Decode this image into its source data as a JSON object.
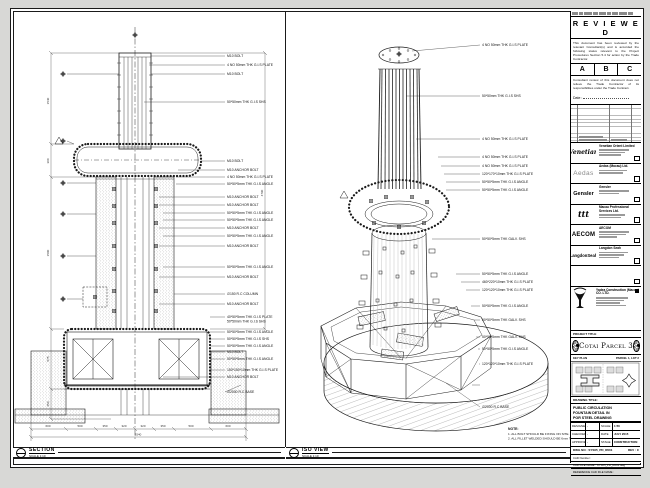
{
  "left_view": {
    "title": "SECTION",
    "scale": "SCALE 1:10",
    "labels": [
      "M10 BOLT",
      "4 NO 50mm THK G.I.S PLATE",
      "M10 BOLT",
      "50*50mm THK G.I.S SHS",
      "M10 BOLT",
      "M10 ANCHOR BOLT",
      "4 NO 50mm THK G.I.S PLATE",
      "50*50*5mm THK G.I.S ANGLE",
      "M10 ANCHOR BOLT",
      "M10 ANCHOR BOLT",
      "50*50*5mm THK G.I.S ANGLE",
      "50*50*5mm THK G.I.S ANGLE",
      "M10 ANCHOR BOLT",
      "50*50*5mm THK G.I.S ANGLE",
      "M10 ANCHOR BOLT",
      "50*50*5mm THK G.I.S ANGLE",
      "M10 ANCHOR BOLT",
      "∅150 R.C COLUMN",
      "M10 ANCHOR BOLT",
      "40*50*5mm THK G.I.S PLATE",
      "50*50mm THK G.I.S SHS",
      "50*50*5mm THK G.I.S ANGLE",
      "50*50*5mm THK G.I.S SHS",
      "50*50*5mm THK G.I.S ANGLE",
      "M10 BOLT",
      "50*50*5mm THK G.I.S ANGLE",
      "150*150*10mm THK G.I.S PLATE",
      "M10 ANCHOR BOLT",
      "∅2000 R.C BASE"
    ],
    "dims_left": [
      "1540",
      "300",
      "1500",
      "575",
      "650"
    ],
    "dim_right": "4790",
    "dims_bottom": [
      "600",
      "500",
      "350",
      "320",
      "320",
      "350",
      "500",
      "600"
    ],
    "dim_total": "3540"
  },
  "iso_view": {
    "title": "ISO VIEW",
    "scale": "SCALE 1:10",
    "labels": [
      "4 NO 50mm THK G.I.S PLATE",
      "50*50mm THK G.I.S SHS",
      "4 NO 50mm THK G.I.S PLATE",
      "4 NO 50mm THK G.I.S PLATE",
      "4 NO 50mm THK G.I.S PLATE",
      "120*170*10mm THK G.I.S PLATE",
      "50*50*5mm THK G.I.S ANGLE",
      "50*50*5mm THK G.I.S ANGLE",
      "50*50*5mm THK GALV. SHS",
      "50*50*5mm THK G.I.S ANGLE",
      "460*220*10mm THK G.I.S PLATE",
      "120*120*10mm THK G.I.S PLATE",
      "50*50*5mm THK G.I.S ANGLE",
      "50*50*5mm THK GALV. SHS",
      "50*50*5mm THK GALV. SHS",
      "50*50*5mm THK G.I.S ANGLE",
      "120*120*10mm THK G.I.S PLATE",
      "∅2000 R.C BASE"
    ],
    "note_title": "NOTE:",
    "note_line1": "1. ALL BOLT SHOULD BE FIXING ON SITE.",
    "note_line2": "2. ALL FILLET WELDED SHOULD BE 6mm THK."
  },
  "title_block": {
    "stamp": {
      "title": "R E V I E W E D",
      "para1": "This document has been reviewed by the relevant Consultant(s) and is accorded the following status relevant to the Project Procedures Section 5.4 for action by the Trade Contractor.",
      "statuses": [
        "A",
        "B",
        "C"
      ],
      "para2": "Consultant review of this document does not relieve the Trade Contractor of its responsibilities under the Trade Contract.",
      "date_label": "Date :"
    },
    "consultants": [
      {
        "logo": "Venetian",
        "name": "Venetian Orient Limited"
      },
      {
        "logo": "Aedas",
        "name": "Aedas (Macau) Ltd."
      },
      {
        "logo": "Gensler",
        "name": "Gensler"
      },
      {
        "logo": "ttt",
        "name": "Macau Professional Services Ltd."
      },
      {
        "logo": "AECOM",
        "name": "AECOM"
      },
      {
        "logo": "LangdonSeah",
        "name": "Langdon Seah"
      }
    ],
    "contractor": {
      "name": "Yadea Construction (Macau) CO. LTD."
    },
    "project": {
      "label": "PROJECT TITLE",
      "title": "Cotai Parcel 3"
    },
    "keyplan": {
      "label": "KEY PLAN",
      "parcel": "PARCEL 1, LOT 2"
    },
    "drawing": {
      "label": "DRAWING TITLE:",
      "line1": "PUBLIC CIRCULATION",
      "line2": "FOUNTAIN DETAIL IN",
      "line3": "POR STEEL DRAWING"
    },
    "fields": {
      "designed_label": "DESIGNED",
      "designed": "-",
      "checked_label": "CHECKED",
      "checked": "-",
      "approved_label": "APPROVED",
      "approved": "-",
      "scale_label": "SCALE",
      "scale": "1:50",
      "date_label": "DATE",
      "date": "JULY 2015",
      "stage_label": "STAGE",
      "stage": "CONSTRUCTION",
      "dwgno_label": "DWG NO :",
      "dwgno": "SYS05_PD_R001",
      "rev_label": "REV :",
      "rev": "C",
      "cadnum_label": "CAD Number :",
      "cadfile_label": "CAD FILE NAME :",
      "cadfile": "SYS05_PD_R001.dwg",
      "ref_label": "REFERENCE CAD FILE NAME :"
    }
  }
}
